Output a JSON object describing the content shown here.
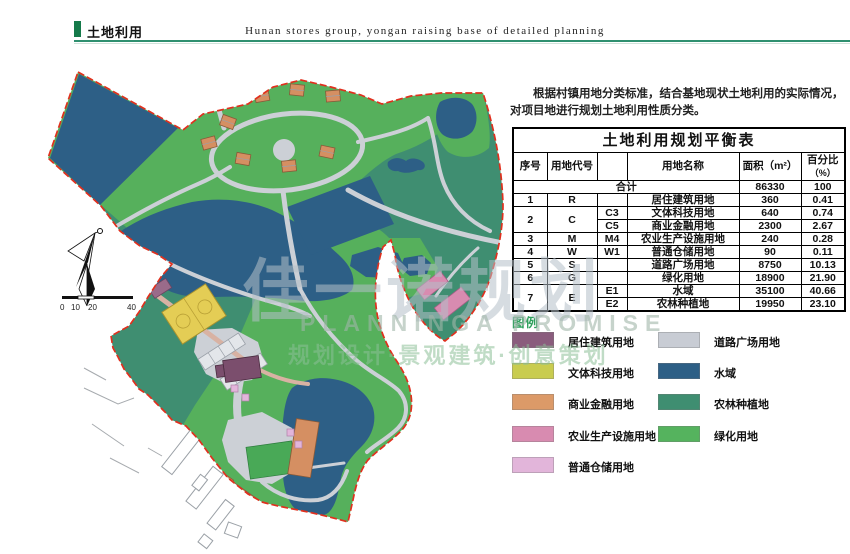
{
  "header": {
    "title": "土地利用",
    "subtitle": "Hunan stores group, yongan raising base of detailed planning",
    "accent_color": "#157a4a"
  },
  "intro": "根据村镇用地分类标准，结合基地现状土地利用的实际情况，对项目地进行规划土地利用性质分类。",
  "table": {
    "title": "土地利用规划平衡表",
    "headers": {
      "seq": "序号",
      "code": "用地代号",
      "name": "用地名称",
      "area": "面积（m²）",
      "pct": "百分比",
      "pct_unit": "（%）"
    },
    "total": {
      "label": "合计",
      "area": "86330",
      "pct": "100"
    },
    "rows": [
      {
        "seq": "1",
        "code": "R",
        "sub": "",
        "name": "居住建筑用地",
        "area": "360",
        "pct": "0.41"
      },
      {
        "seq": "2",
        "code": "C",
        "sub": "C3",
        "name": "文体科技用地",
        "area": "640",
        "pct": "0.74"
      },
      {
        "sub": "C5",
        "name": "商业金融用地",
        "area": "2300",
        "pct": "2.67"
      },
      {
        "seq": "3",
        "code": "M",
        "sub": "M4",
        "name": "农业生产设施用地",
        "area": "240",
        "pct": "0.28"
      },
      {
        "seq": "4",
        "code": "W",
        "sub": "W1",
        "name": "普通仓储用地",
        "area": "90",
        "pct": "0.11"
      },
      {
        "seq": "5",
        "code": "S",
        "sub": "",
        "name": "道路广场用地",
        "area": "8750",
        "pct": "10.13"
      },
      {
        "seq": "6",
        "code": "G",
        "sub": "",
        "name": "绿化用地",
        "area": "18900",
        "pct": "21.90"
      },
      {
        "seq": "7",
        "code": "E",
        "sub": "E1",
        "name": "水域",
        "area": "35100",
        "pct": "40.66"
      },
      {
        "sub": "E2",
        "name": "农林种植地",
        "area": "19950",
        "pct": "23.10"
      }
    ]
  },
  "legend": {
    "title": "图例",
    "title_color": "#2ea05c",
    "left": [
      {
        "label": "居住建筑用地",
        "color": "#8a5c7d"
      },
      {
        "label": "文体科技用地",
        "color": "#c9cc4f"
      },
      {
        "label": "商业金融用地",
        "color": "#dc9a68"
      },
      {
        "label": "农业生产设施用地",
        "color": "#d88bb0"
      },
      {
        "label": "普通仓储用地",
        "color": "#e2b5da"
      }
    ],
    "right": [
      {
        "label": "道路广场用地",
        "color": "#c8ccd4"
      },
      {
        "label": "水域",
        "color": "#2d5f86"
      },
      {
        "label": "农林种植地",
        "color": "#3f8e71"
      },
      {
        "label": "绿化用地",
        "color": "#55b35e"
      }
    ]
  },
  "map": {
    "scale_labels": [
      "0",
      "10",
      "20",
      "40"
    ],
    "palette": {
      "boundary": "#e0301e",
      "water": "#2d5f86",
      "farmland": "#3f8e71",
      "greenery": "#56b05c",
      "road": "#ccd0d6",
      "residential": "#7b4e6d",
      "culture_court": "#e4cd55",
      "commerce": "#d58f62",
      "agriculture_facility": "#d88bb0",
      "warehouse": "#e2b5da"
    }
  },
  "watermark": {
    "big": "佳一诺规划",
    "en": "PLANNINGA  PROMISE",
    "cn": "规划设计·景观建筑·创意策划"
  }
}
